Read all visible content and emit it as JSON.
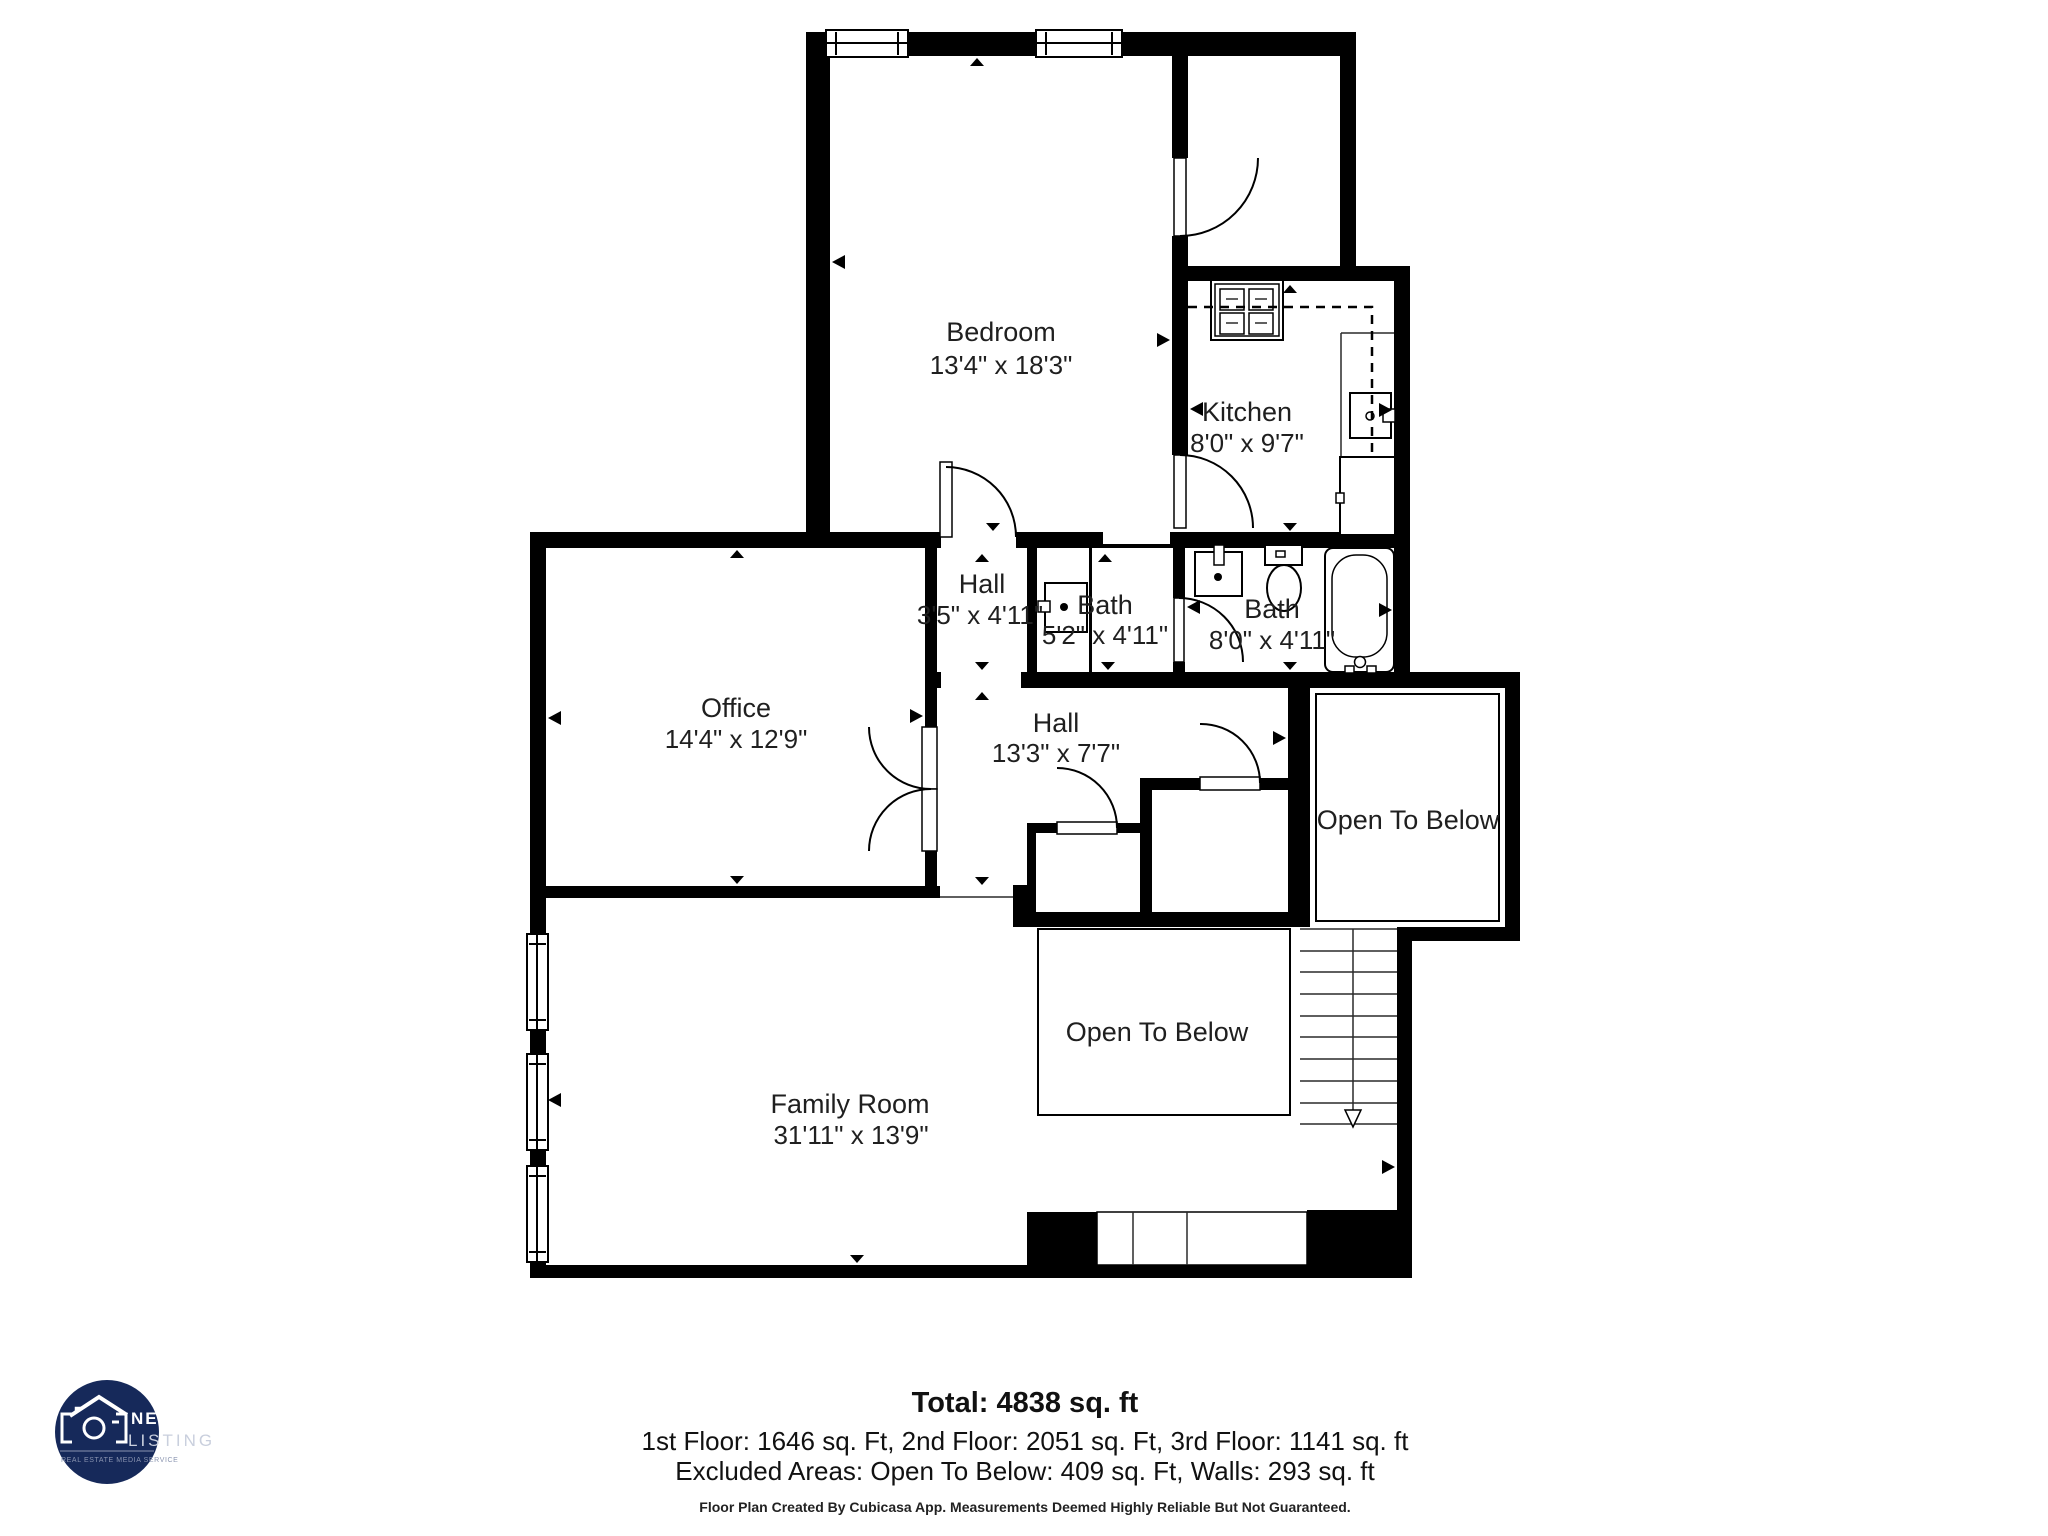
{
  "colors": {
    "wall": "#000000",
    "background": "#ffffff",
    "label_text": "#1f1f1f",
    "logo_navy": "#16295a",
    "logo_subtext": "#8a94b0"
  },
  "rooms": {
    "bedroom": {
      "name": "Bedroom",
      "dims": "13'4\" x 18'3\""
    },
    "kitchen": {
      "name": "Kitchen",
      "dims": "8'0\" x 9'7\""
    },
    "hall_upper": {
      "name": "Hall",
      "dims": "3'5\" x 4'11\""
    },
    "bath_small": {
      "name": "Bath",
      "dims": "5'2\" x 4'11\""
    },
    "bath_large": {
      "name": "Bath",
      "dims": "8'0\" x 4'11\""
    },
    "office": {
      "name": "Office",
      "dims": "14'4\" x 12'9\""
    },
    "hall_lower": {
      "name": "Hall",
      "dims": "13'3\" x 7'7\""
    },
    "open_below_upper": {
      "name": "Open To Below"
    },
    "open_below_lower": {
      "name": "Open To Below"
    },
    "family_room": {
      "name": "Family Room",
      "dims": "31'11\" x 13'9\""
    }
  },
  "summary": {
    "total": "Total: 4838 sq. ft",
    "floors": "1st Floor: 1646 sq. Ft, 2nd Floor: 2051 sq. Ft, 3rd Floor: 1141 sq. ft",
    "excluded": "Excluded Areas: Open To Below: 409 sq. Ft, Walls: 293 sq. ft",
    "disclaimer": "Floor Plan Created By Cubicasa App. Measurements Deemed Highly Reliable But Not Guaranteed."
  },
  "logo": {
    "brand_top": "NEXT",
    "brand_bottom": "LISTING",
    "tagline": "REAL ESTATE MEDIA SERVICE"
  }
}
